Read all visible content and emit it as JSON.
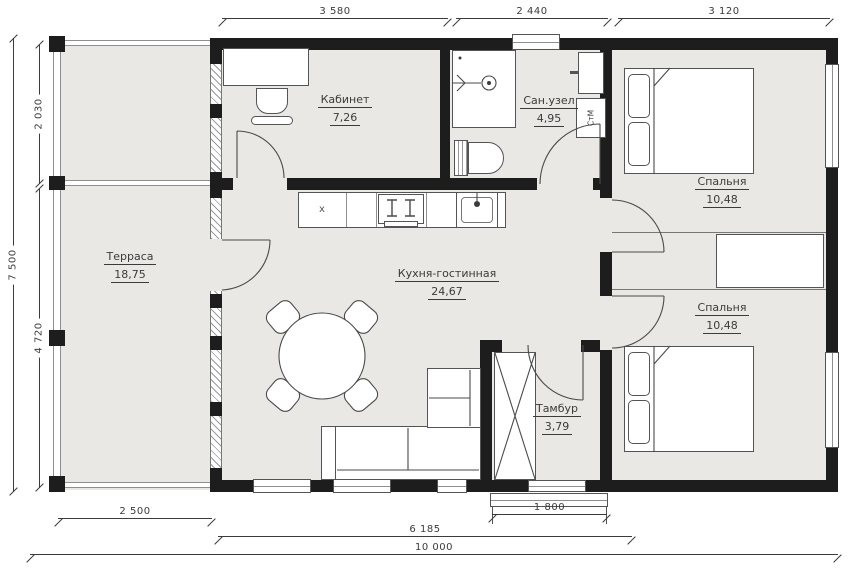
{
  "plan": {
    "title": "house-floor-plan",
    "rooms": [
      {
        "id": "terrace",
        "name": "Терраса",
        "area": "18,75"
      },
      {
        "id": "office",
        "name": "Кабинет",
        "area": "7,26"
      },
      {
        "id": "bathroom",
        "name": "Сан.узел",
        "area": "4,95"
      },
      {
        "id": "living",
        "name": "Кухня-гостинная",
        "area": "24,67"
      },
      {
        "id": "bedroom1",
        "name": "Спальня",
        "area": "10,48"
      },
      {
        "id": "bedroom2",
        "name": "Спальня",
        "area": "10,48"
      },
      {
        "id": "tambour",
        "name": "Тамбур",
        "area": "3,79"
      }
    ],
    "appliances": {
      "washer": "СтМ",
      "kitchen_mark": "x"
    },
    "dimensions": {
      "top": [
        "3 580",
        "2 440",
        "3 120"
      ],
      "left": [
        "7 500",
        "2 030",
        "4 720"
      ],
      "bottom": [
        "2 500",
        "1 800",
        "6 185",
        "10 000"
      ]
    },
    "colors": {
      "wall": "#1d1d1d",
      "floor": "#e9e8e4",
      "line": "#4a4a4a",
      "text": "#3b3b3b"
    }
  }
}
